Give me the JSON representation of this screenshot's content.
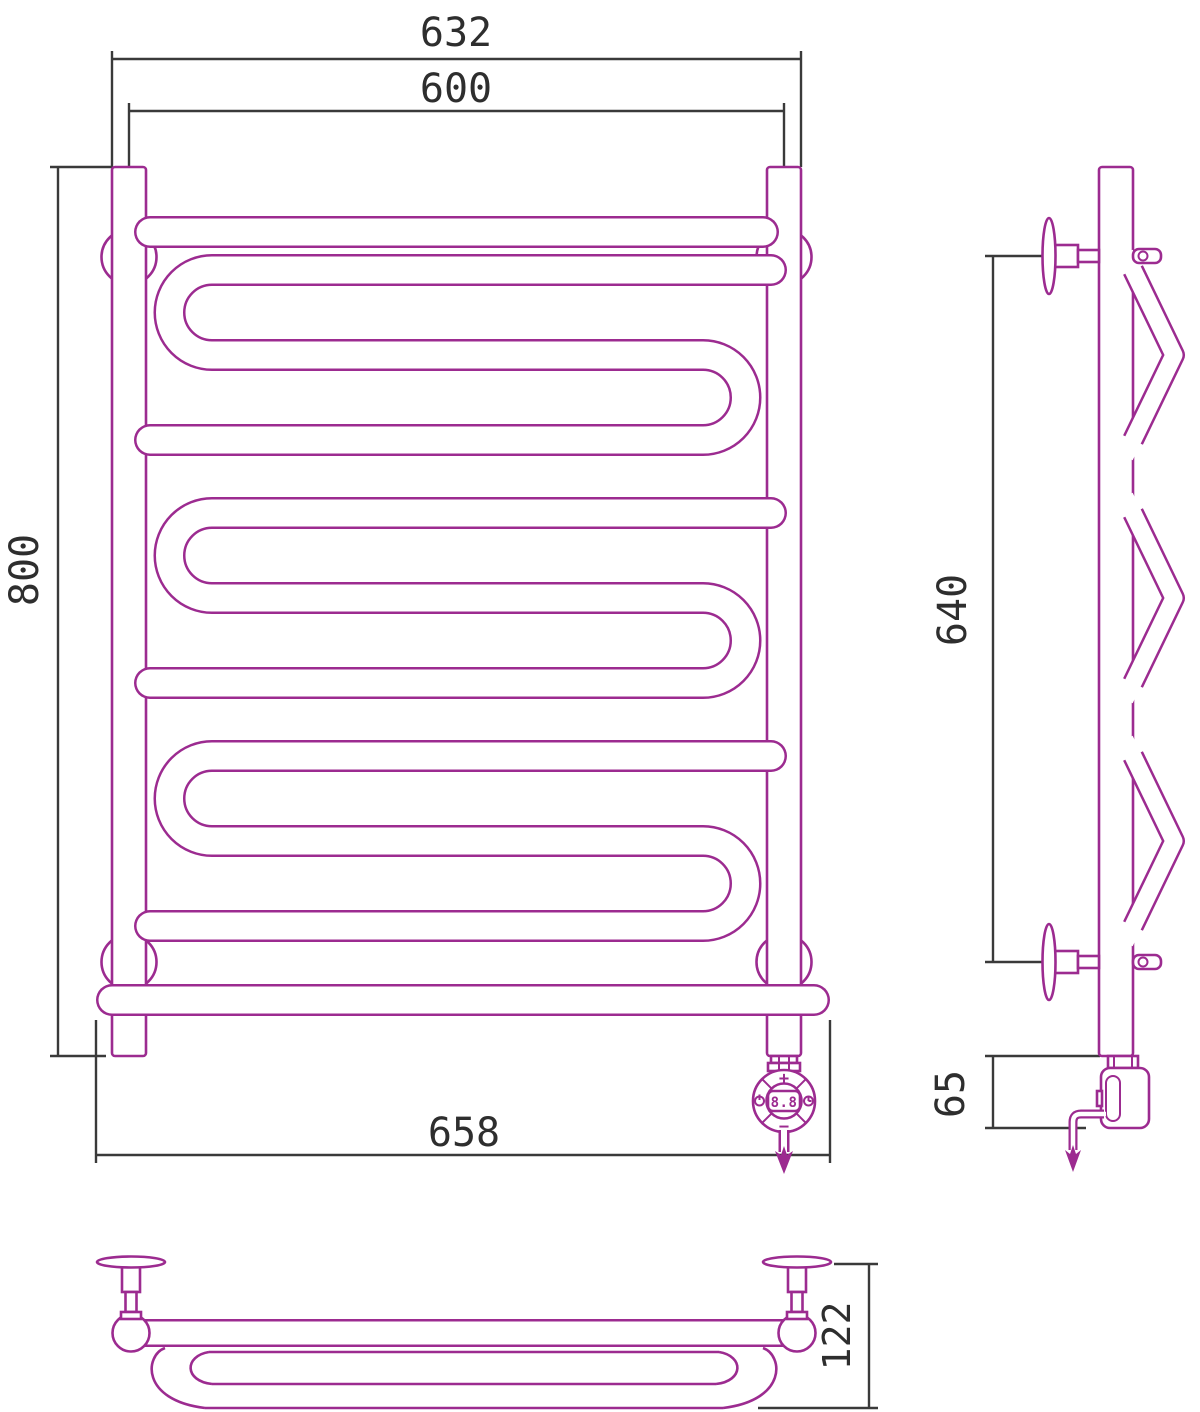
{
  "drawing_title": "electric-towel-rail-technical-drawing",
  "colors": {
    "outline": "#9C2B90",
    "dimension_lines": "#3A3A3A",
    "dimension_text": "#2E2E2E",
    "background": "#FFFFFF"
  },
  "views": {
    "front": {
      "name": "front-view",
      "dimensions": {
        "outer_width": "632",
        "axis_width": "600",
        "height": "800",
        "bottom_width": "658"
      }
    },
    "side": {
      "name": "side-view",
      "dimensions": {
        "mount_span": "640",
        "heater_height": "65"
      }
    },
    "bottom": {
      "name": "bottom-view",
      "dimensions": {
        "depth": "122"
      }
    }
  },
  "thermostat": {
    "plus_label": "+",
    "minus_label": "−",
    "display_value": "8.8"
  }
}
